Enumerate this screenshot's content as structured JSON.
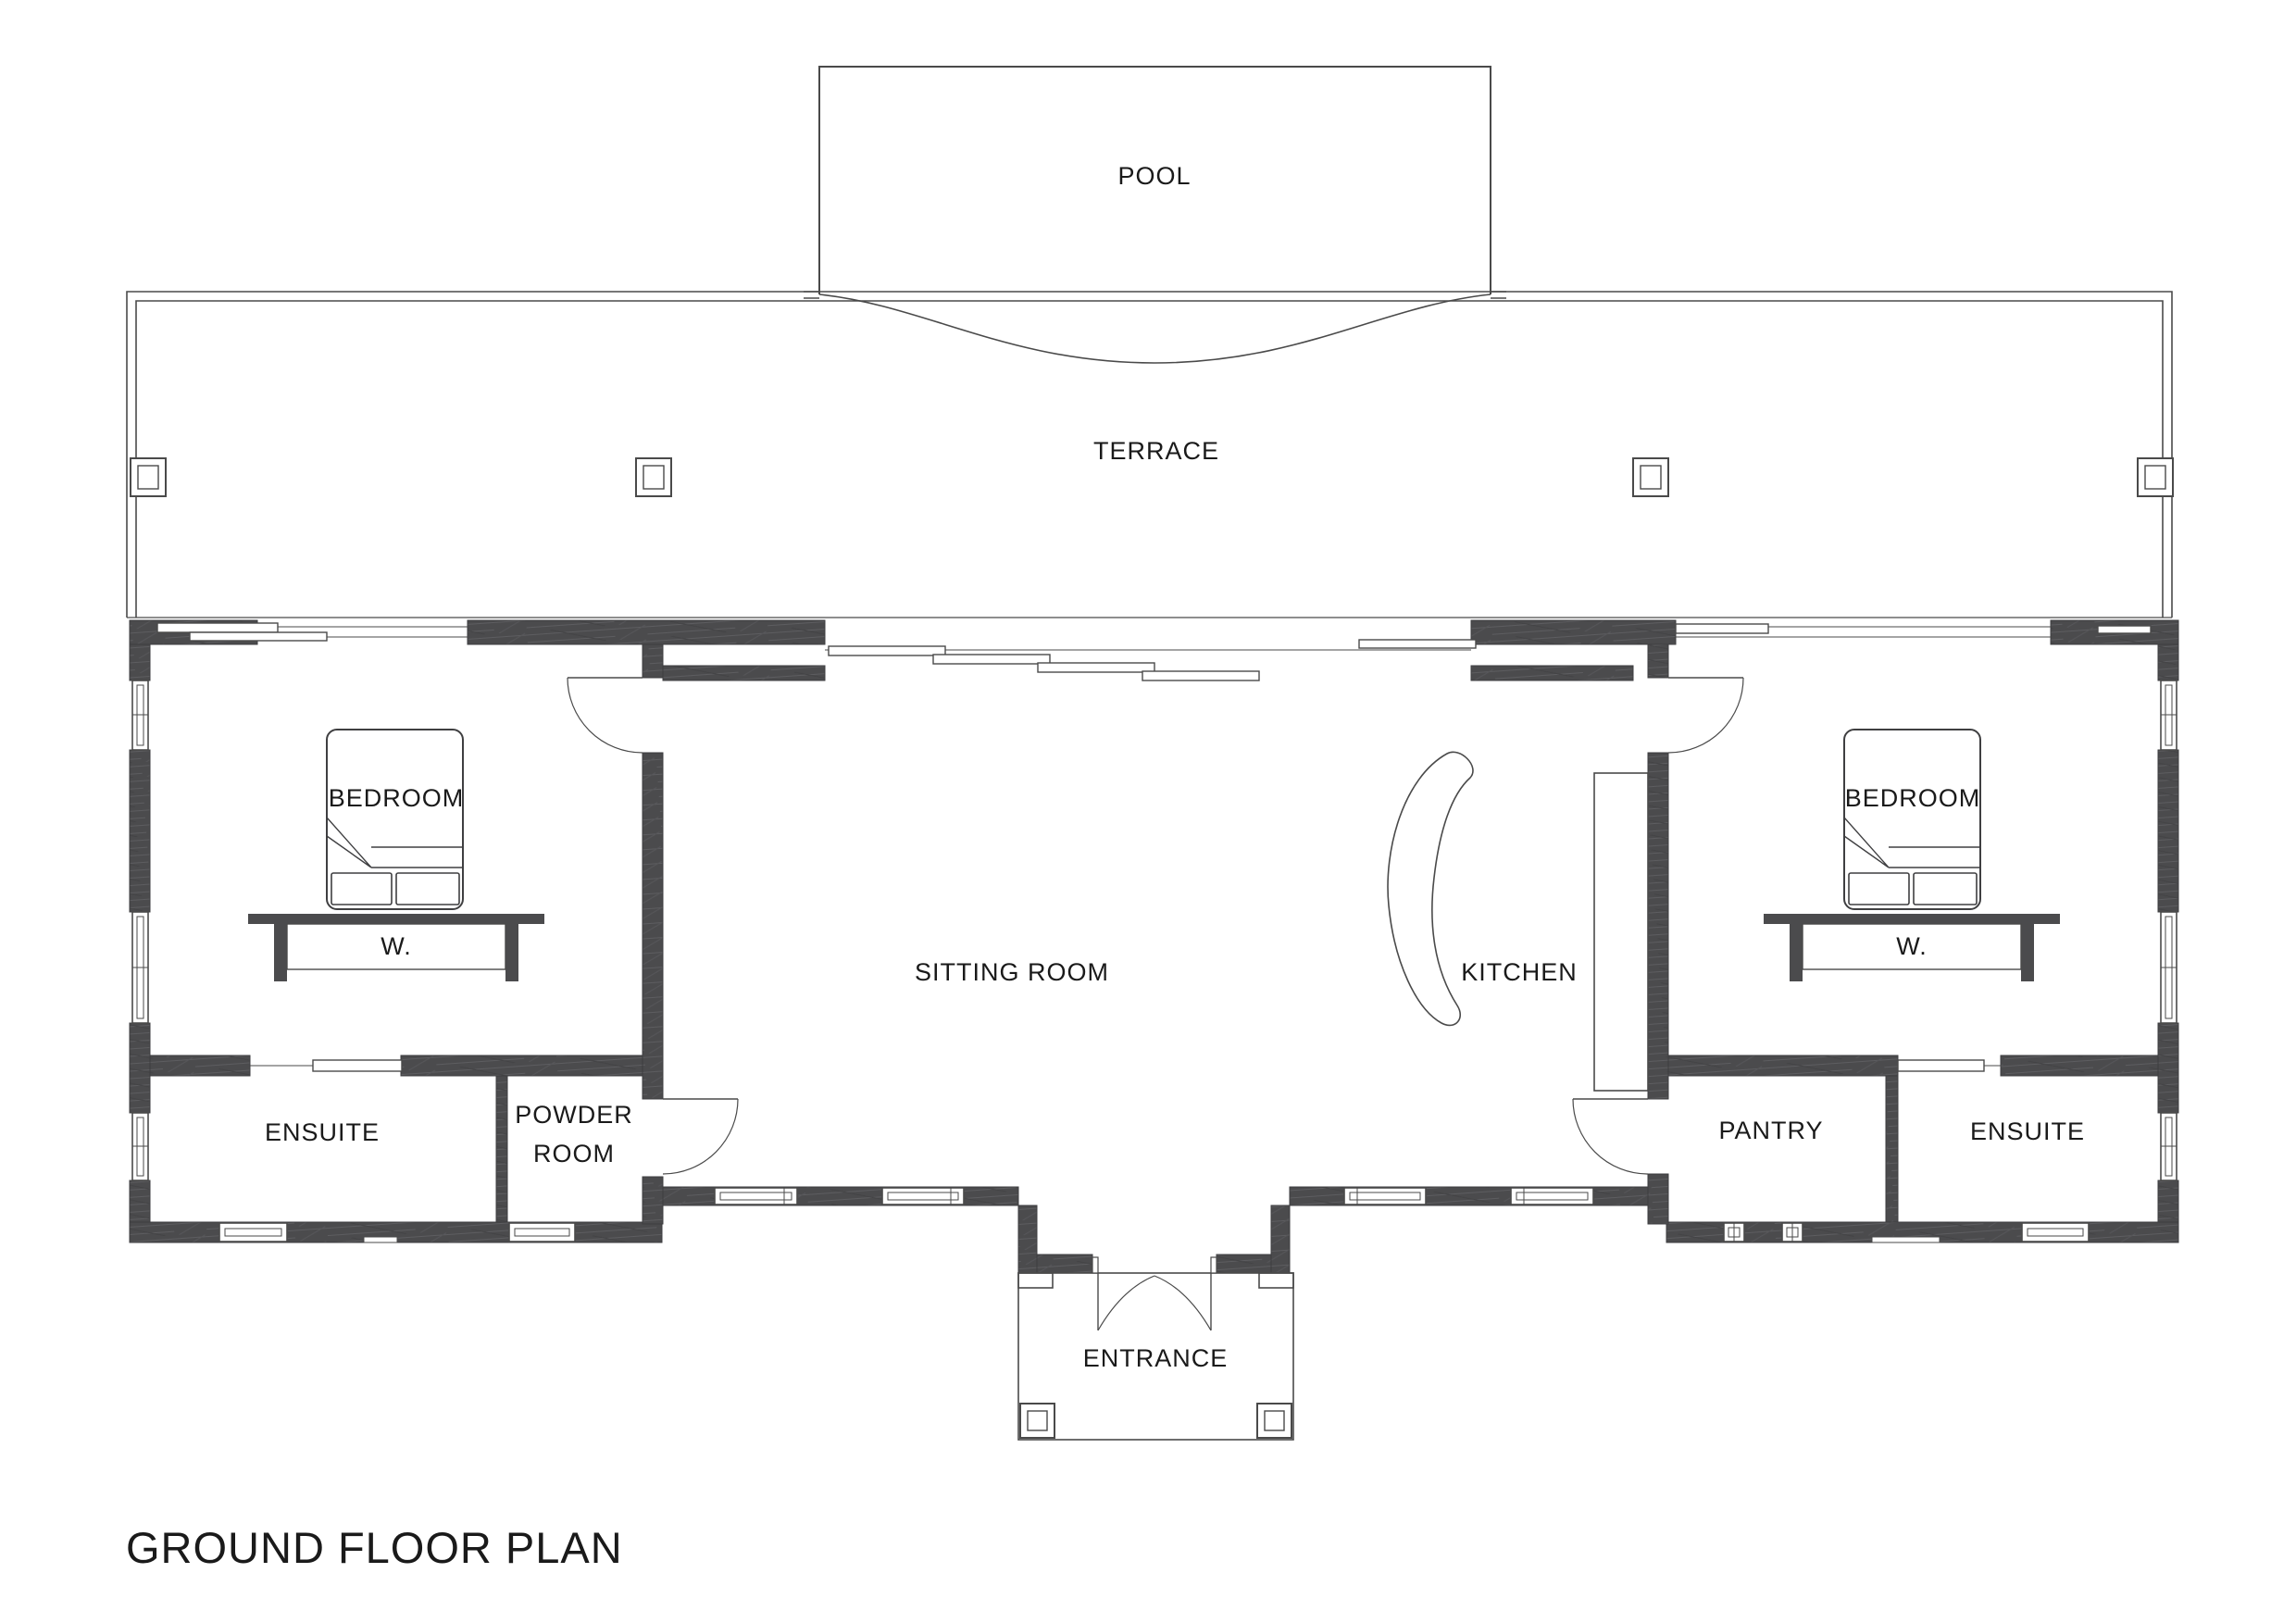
{
  "drawing": {
    "title": "GROUND FLOOR PLAN"
  },
  "rooms": {
    "pool": "POOL",
    "terrace": "TERRACE",
    "bedroom_left": "BEDROOM",
    "bedroom_right": "BEDROOM",
    "wardrobe_left": "W.",
    "wardrobe_right": "W.",
    "sitting_room": "SITTING ROOM",
    "kitchen": "KITCHEN",
    "ensuite_left": "ENSUITE",
    "powder_room_line1": "POWDER",
    "powder_room_line2": "ROOM",
    "pantry": "PANTRY",
    "ensuite_right": "ENSUITE",
    "entrance": "ENTRANCE"
  },
  "colors": {
    "wall": "#4b4b4d",
    "line": "#4a4a4a",
    "text": "#1a1a1a",
    "background": "#ffffff"
  }
}
